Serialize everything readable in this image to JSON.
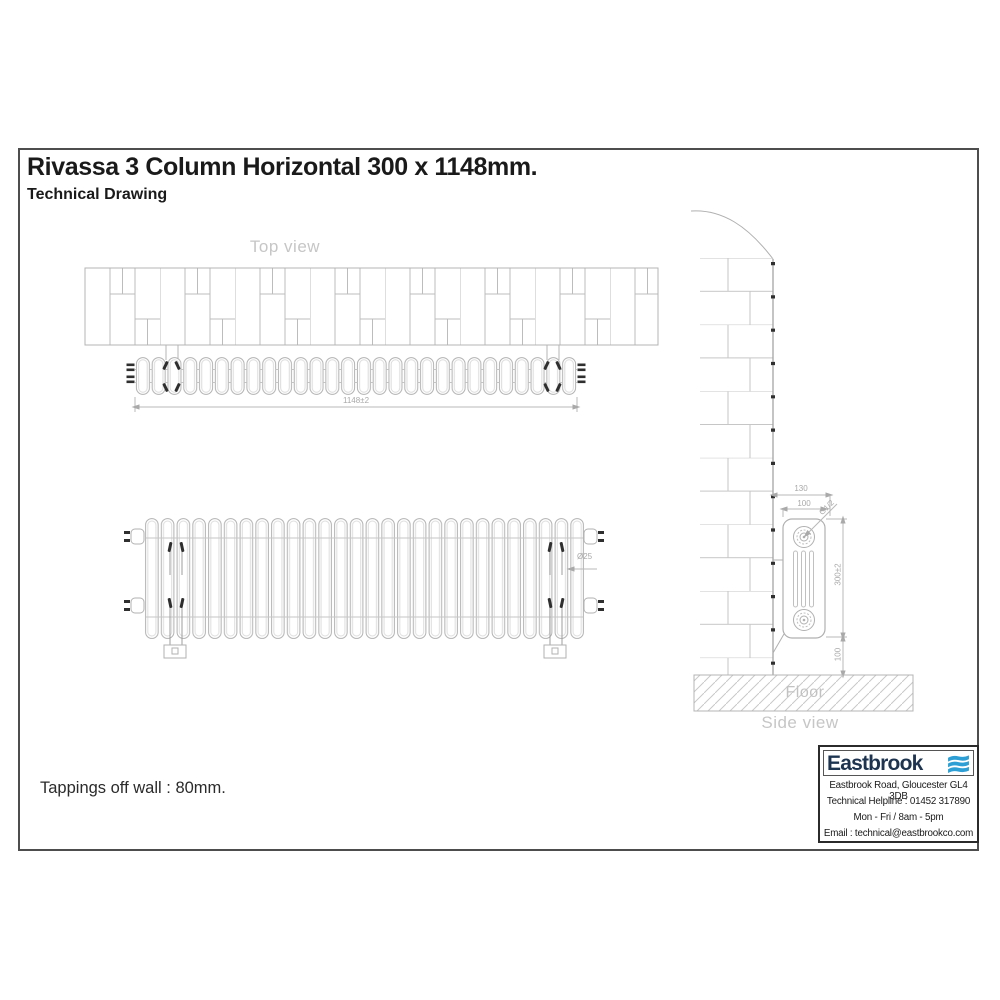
{
  "page": {
    "title": "Rivassa 3 Column Horizontal 300 x 1148mm.",
    "subtitle": "Technical Drawing",
    "tappings_note": "Tappings off wall : 80mm."
  },
  "top_view": {
    "label": "Top view",
    "length_dim": "1148±2"
  },
  "front_view": {
    "tube_dim": "Ø25"
  },
  "side_view": {
    "label": "Side view",
    "floor_label": "Floor",
    "overall_depth_dim": "130",
    "depth_dim": "100",
    "tapping_thread_dim": "G1/2",
    "height_dim": "300±2",
    "floor_clearance_dim": "100"
  },
  "info_box": {
    "brand": "Eastbrook",
    "logo_icon": "waves-icon",
    "address": "Eastbrook Road, Gloucester GL4 3DB",
    "helpline": "Technical Helpline : 01452 317890",
    "hours": "Mon - Fri / 8am - 5pm",
    "email": "Email : technical@eastbrookco.com"
  },
  "colors": {
    "brand_navy": "#1d3450",
    "brand_blue": "#2e9fd4",
    "line_gray": "#b4b4b4",
    "label_gray": "#c6c6c6",
    "ink": "#1a1a1a"
  }
}
